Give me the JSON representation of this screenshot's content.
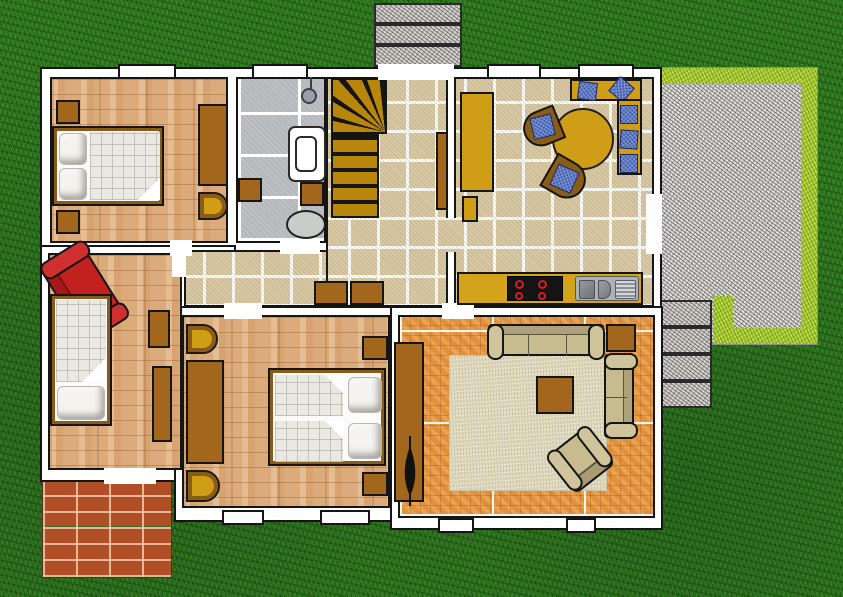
{
  "scene": {
    "kind": "residential floor plan, top-down view",
    "setting": "house plan placed on a lawn with terrace, walkways and brick patio",
    "visible_text": []
  },
  "palette": {
    "grass": "#2e7a1f",
    "wall": "#ffffff",
    "outline": "#151515",
    "wood": "#dcab7c",
    "tile": "#d8c9a5",
    "bath_tile": "#b6b9bc",
    "parquet": "#e0913c",
    "rug": "#ded7bb",
    "furniture_brown": "#a2661c",
    "furniture_gold": "#cf9d16",
    "stair_gold": "#b8860b",
    "cushion_blue": "#5877c9",
    "sofa_red": "#c32020",
    "sofa_tan": "#c7bc90",
    "counter": "#d2a31b",
    "gravel": "#d8d5d0",
    "hedge": "#a9cb30",
    "brick": "#b04e28",
    "steel": "#aeb2b6"
  },
  "outdoor": {
    "front_walkway": {
      "slabs": 3,
      "material": "granite gravel"
    },
    "terrace": {
      "material": "gravel",
      "border": "lime hedge",
      "side": "east"
    },
    "side_steps": {
      "slabs": 4,
      "material": "granite gravel"
    },
    "brick_patio": {
      "material": "red brick",
      "corner": "south-west"
    }
  },
  "rooms": [
    {
      "name": "bedroom-1",
      "floor": "light wood parquet",
      "furniture": [
        "double-bed",
        "pillows",
        "nightstand",
        "nightstand",
        "wardrobe",
        "half-round-chair"
      ]
    },
    {
      "name": "bathroom",
      "floor": "gray tile",
      "furniture": [
        "shower",
        "bathtub",
        "cabinet",
        "cabinet",
        "toilet"
      ]
    },
    {
      "name": "staircase",
      "floor": "winder stairs, golden treads"
    },
    {
      "name": "hallway",
      "floor": "beige tile",
      "furniture": [
        "cabinet",
        "cabinet",
        "sideboard"
      ]
    },
    {
      "name": "dining-kitchen",
      "floor": "beige tile",
      "furniture": [
        "round-table",
        "chair-blue-cushion",
        "chair-blue-cushion",
        "corner-bench-blue-cushions",
        "tall-cabinet",
        "kitchen-counter",
        "cooktop-4-burners",
        "sink-with-drainer"
      ]
    },
    {
      "name": "study-guest-room",
      "floor": "light wood parquet",
      "furniture": [
        "red-sofa",
        "single-bed",
        "desk",
        "shelf"
      ]
    },
    {
      "name": "bedroom-2",
      "floor": "light wood parquet",
      "furniture": [
        "double-bed",
        "pillows",
        "wardrobe",
        "half-round-chair",
        "half-round-chair",
        "nightstand",
        "nightstand"
      ]
    },
    {
      "name": "living-room",
      "floor": "orange parquet",
      "furniture": [
        "rug",
        "sofa-3-seat",
        "sofa-2-seat",
        "armchair",
        "coffee-table",
        "side-table",
        "sideboard-with-plant"
      ]
    }
  ]
}
